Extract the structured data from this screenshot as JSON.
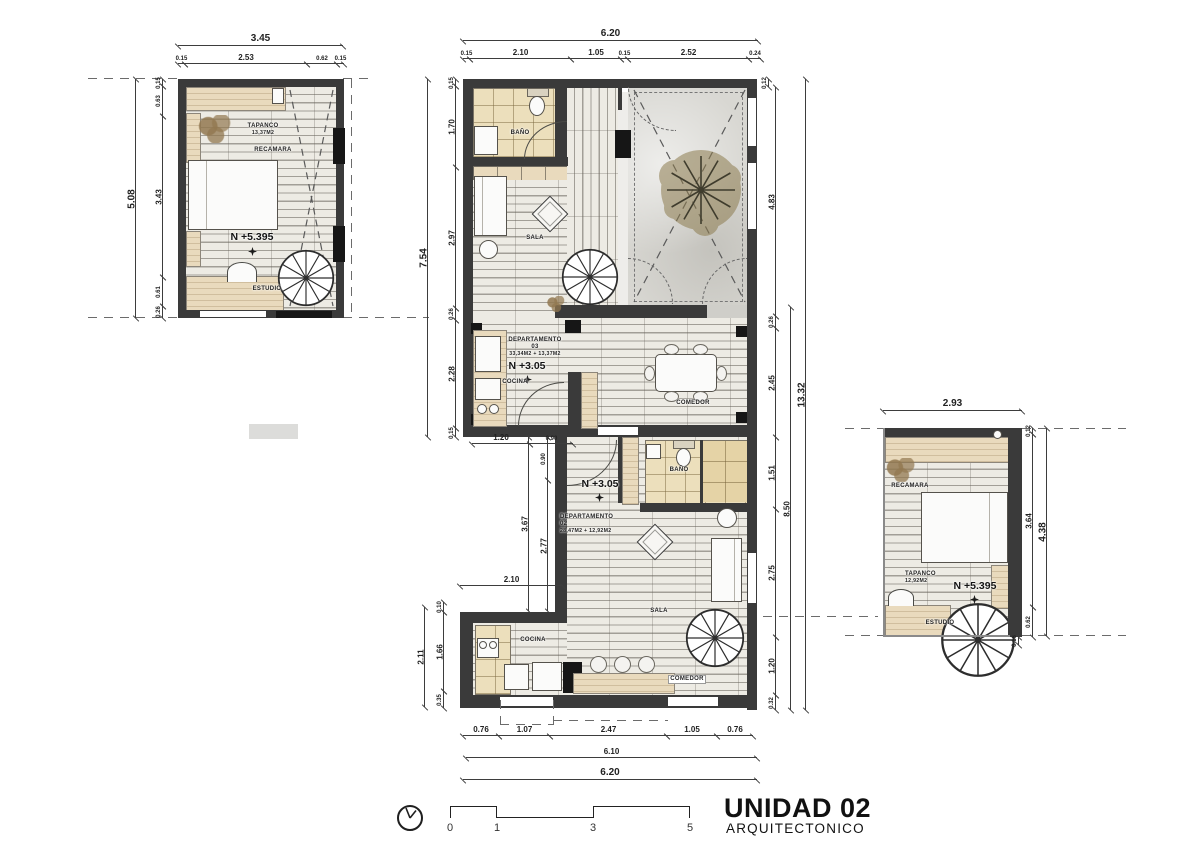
{
  "title": {
    "unit": "UNIDAD 02",
    "subtitle": "ARQUITECTONICO"
  },
  "scalebar": {
    "t0": "0",
    "t1": "1",
    "t3": "3",
    "t5": "5"
  },
  "labels": {
    "u1_tapanco": "TAPANCO",
    "u1_tapanco_area": "13,37M2",
    "u1_recamara": "RECAMARA",
    "u1_level": "N +5.395",
    "u1_estudio": "ESTUDIO",
    "u3_bano": "BAÑO",
    "u3_sala": "SALA",
    "u3_dept": "DEPARTAMENTO 03",
    "u3_area": "33,34M2 + 13,37M2",
    "u3_level": "N +3.05",
    "u3_cocina": "COCINA",
    "u3_comedor": "COMEDOR",
    "u2_bano": "BAÑO",
    "u2_level": "N +3.05",
    "u2_dept": "DEPARTAMENTO 02",
    "u2_area": "28,47M2 + 12,92M2",
    "u2_sala": "SALA",
    "u2_cocina": "COCINA",
    "u2_comedor": "COMEDOR",
    "r_recamara": "RECAMARA",
    "r_tapanco": "TAPANCO",
    "r_tapanco_area": "12,92M2",
    "r_level": "N +5.395",
    "r_estudio": "ESTUDIO"
  },
  "dims": {
    "tl_total_w": "3.45",
    "tl_w1": "0.15",
    "tl_w2": "2.53",
    "tl_w3": "0.62",
    "tl_w4": "0.15",
    "tl_total_h": "5.08",
    "tl_h0": "0.15",
    "tl_h1": "0.63",
    "tl_h2": "3.43",
    "tl_h3": "0.61",
    "tl_h4": "0.26",
    "c_total_w": "6.20",
    "c_w1": "0.15",
    "c_w2": "2.10",
    "c_w3": "1.05",
    "c_w4": "0.15",
    "c_w5": "2.52",
    "c_w6": "0.24",
    "c_r_top": "0.12",
    "c_left_total": "7.54",
    "c_l1": "0.15",
    "c_l2": "1.70",
    "c_l3": "2.97",
    "c_l4": "0.26",
    "c_l5": "2.28",
    "c_l6": "0.15",
    "c_r1": "4.83",
    "c_r2": "0.26",
    "c_r3": "2.45",
    "c_r_total": "13.32",
    "c_r4": "1.51",
    "c_r5": "8.50",
    "c_r6": "2.75",
    "c_r7": "1.20",
    "c_r8": "0.32",
    "notch_total": "3.67",
    "notch_1": "0.90",
    "notch_2": "2.77",
    "notch_w1": "1.20",
    "notch_w2": "0.90",
    "low_w": "2.10",
    "low_h0": "0.10",
    "low_h1": "1.66",
    "low_h2": "0.35",
    "low_total": "2.11",
    "b_w1": "0.76",
    "b_w2": "1.07",
    "b_w3": "2.47",
    "b_w4": "1.05",
    "b_w5": "0.76",
    "b_sub": "6.10",
    "b_total": "6.20",
    "r_total_w": "2.93",
    "r_r0": "0.12",
    "r_r1": "3.64",
    "r_r_total": "4.38",
    "r_r2": "0.62",
    "r_r3": "0.16"
  }
}
